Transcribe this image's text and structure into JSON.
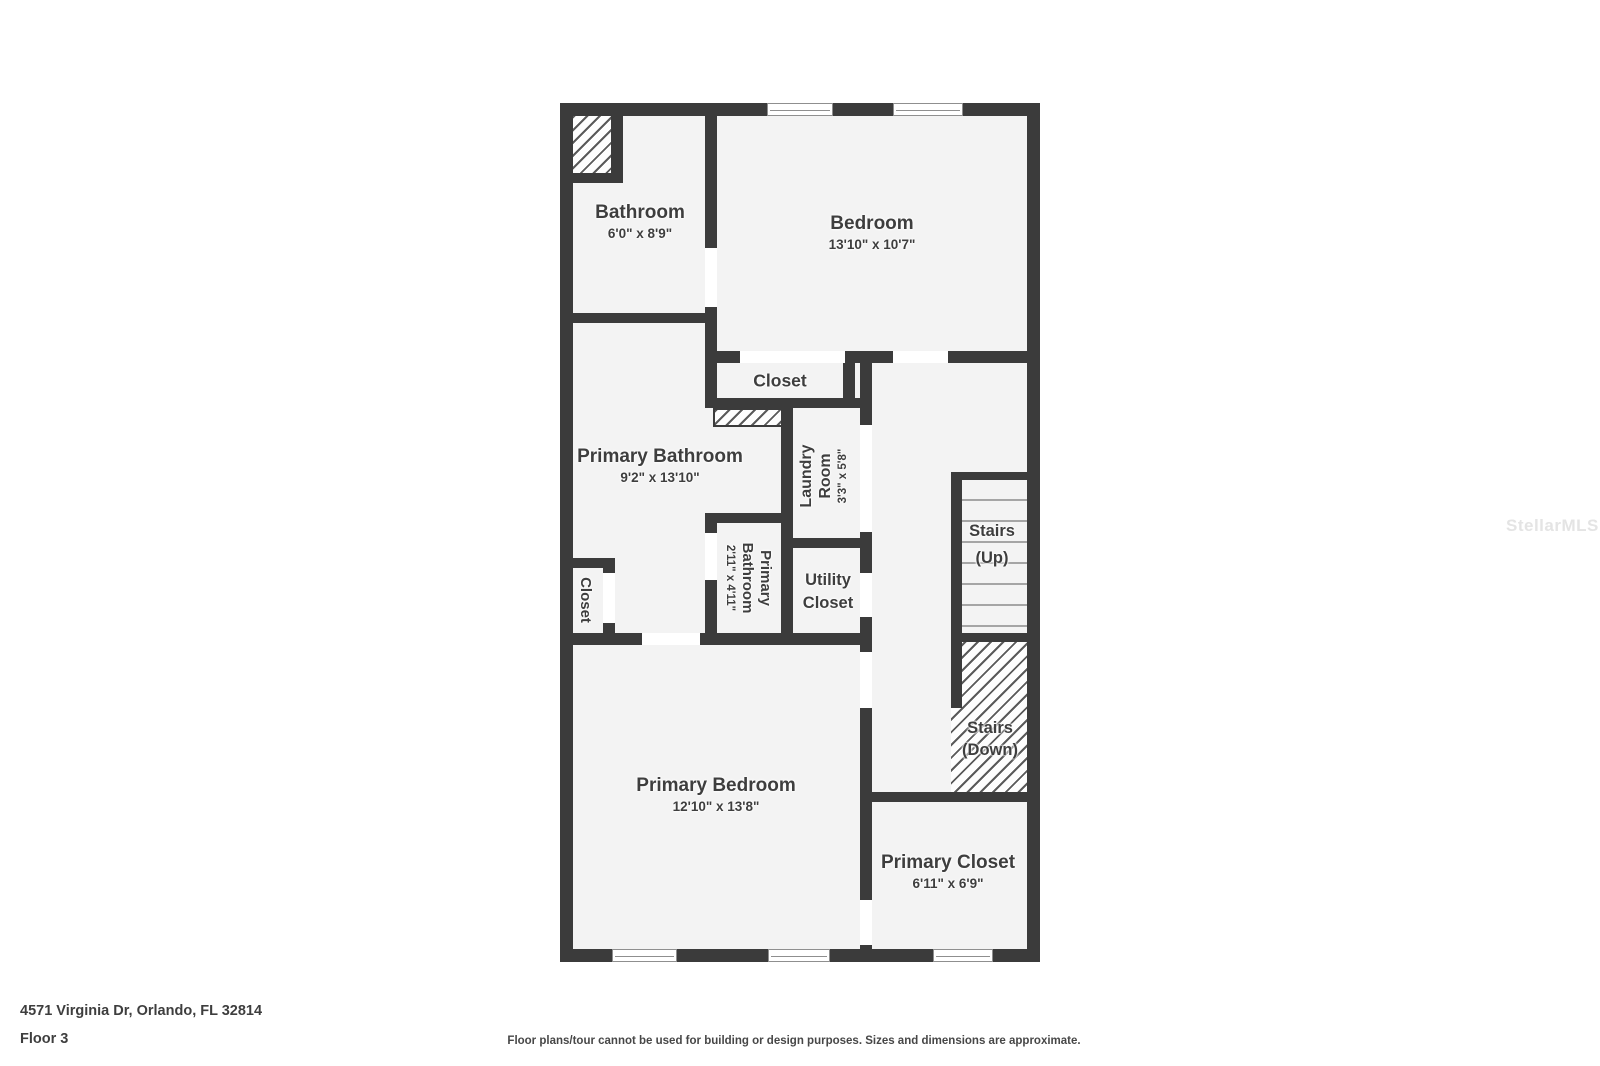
{
  "plan": {
    "rooms": {
      "bathroom": {
        "name": "Bathroom",
        "dims": "6'0\" x 8'9\""
      },
      "bedroom": {
        "name": "Bedroom",
        "dims": "13'10\" x 10'7\""
      },
      "bedroom_closet": {
        "name": "Closet"
      },
      "primary_bathroom": {
        "name": "Primary Bathroom",
        "dims": "9'2\" x 13'10\""
      },
      "laundry": {
        "line1": "Laundry",
        "line2": "Room",
        "dims": "3'3\" x 5'8\""
      },
      "primary_bathroom_small": {
        "line1": "Primary",
        "line2": "Bathroom",
        "dims": "2'11\" x 4'11\""
      },
      "utility_closet": {
        "line1": "Utility",
        "line2": "Closet"
      },
      "hall_closet": {
        "name": "Closet"
      },
      "stairs_up": {
        "line1": "Stairs",
        "line2": "(Up)"
      },
      "stairs_down": {
        "line1": "Stairs",
        "line2": "(Down)"
      },
      "primary_bedroom": {
        "name": "Primary Bedroom",
        "dims": "12'10\" x 13'8\""
      },
      "primary_closet": {
        "name": "Primary Closet",
        "dims": "6'11\" x 6'9\""
      }
    }
  },
  "footer": {
    "address": "4571 Virginia Dr, Orlando, FL 32814",
    "floor": "Floor 3",
    "disclaimer": "Floor plans/tour cannot be used for building or design purposes. Sizes and dimensions are approximate."
  },
  "watermark": "StellarMLS",
  "colors": {
    "wall": "#3b3b3b",
    "floor": "#f3f3f3",
    "text": "#3e3e3e"
  }
}
